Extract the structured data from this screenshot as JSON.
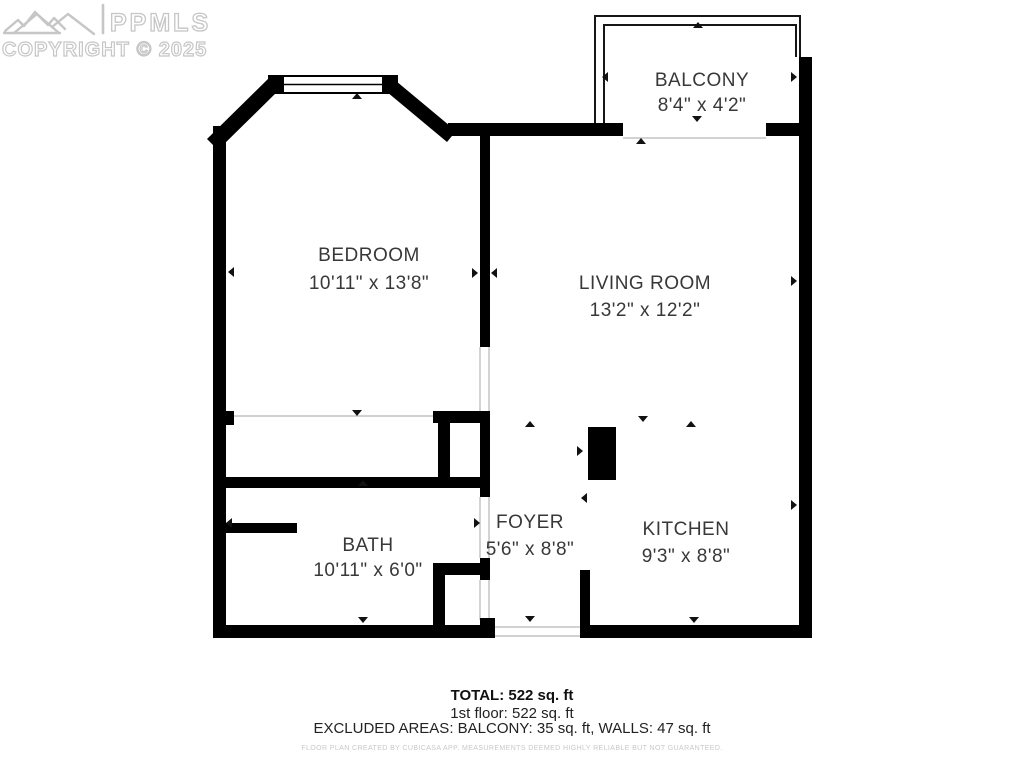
{
  "watermark": {
    "brand": "PPMLS",
    "copyright": "COPYRIGHT © 2025"
  },
  "rooms": [
    {
      "name": "BALCONY",
      "dims": "8'4\" x 4'2\""
    },
    {
      "name": "BEDROOM",
      "dims": "10'11\" x 13'8\""
    },
    {
      "name": "LIVING ROOM",
      "dims": "13'2\" x 12'2\""
    },
    {
      "name": "BATH",
      "dims": "10'11\" x 6'0\""
    },
    {
      "name": "FOYER",
      "dims": "5'6\" x 8'8\""
    },
    {
      "name": "KITCHEN",
      "dims": "9'3\" x 8'8\""
    }
  ],
  "summary": {
    "total": "TOTAL: 522 sq. ft",
    "floor": "1st floor: 522 sq. ft",
    "excluded": "EXCLUDED AREAS: BALCONY: 35 sq. ft, WALLS: 47 sq. ft"
  },
  "disclaimer": "FLOOR PLAN CREATED BY CUBICASA APP. MEASUREMENTS DEEMED HIGHLY RELIABLE BUT NOT GUARANTEED.",
  "colors": {
    "wall": "#000000",
    "label": "#383838",
    "watermark": "#c6c6c6",
    "opening_line": "#c0c0c0",
    "disclaimer": "#c8c8c8"
  }
}
